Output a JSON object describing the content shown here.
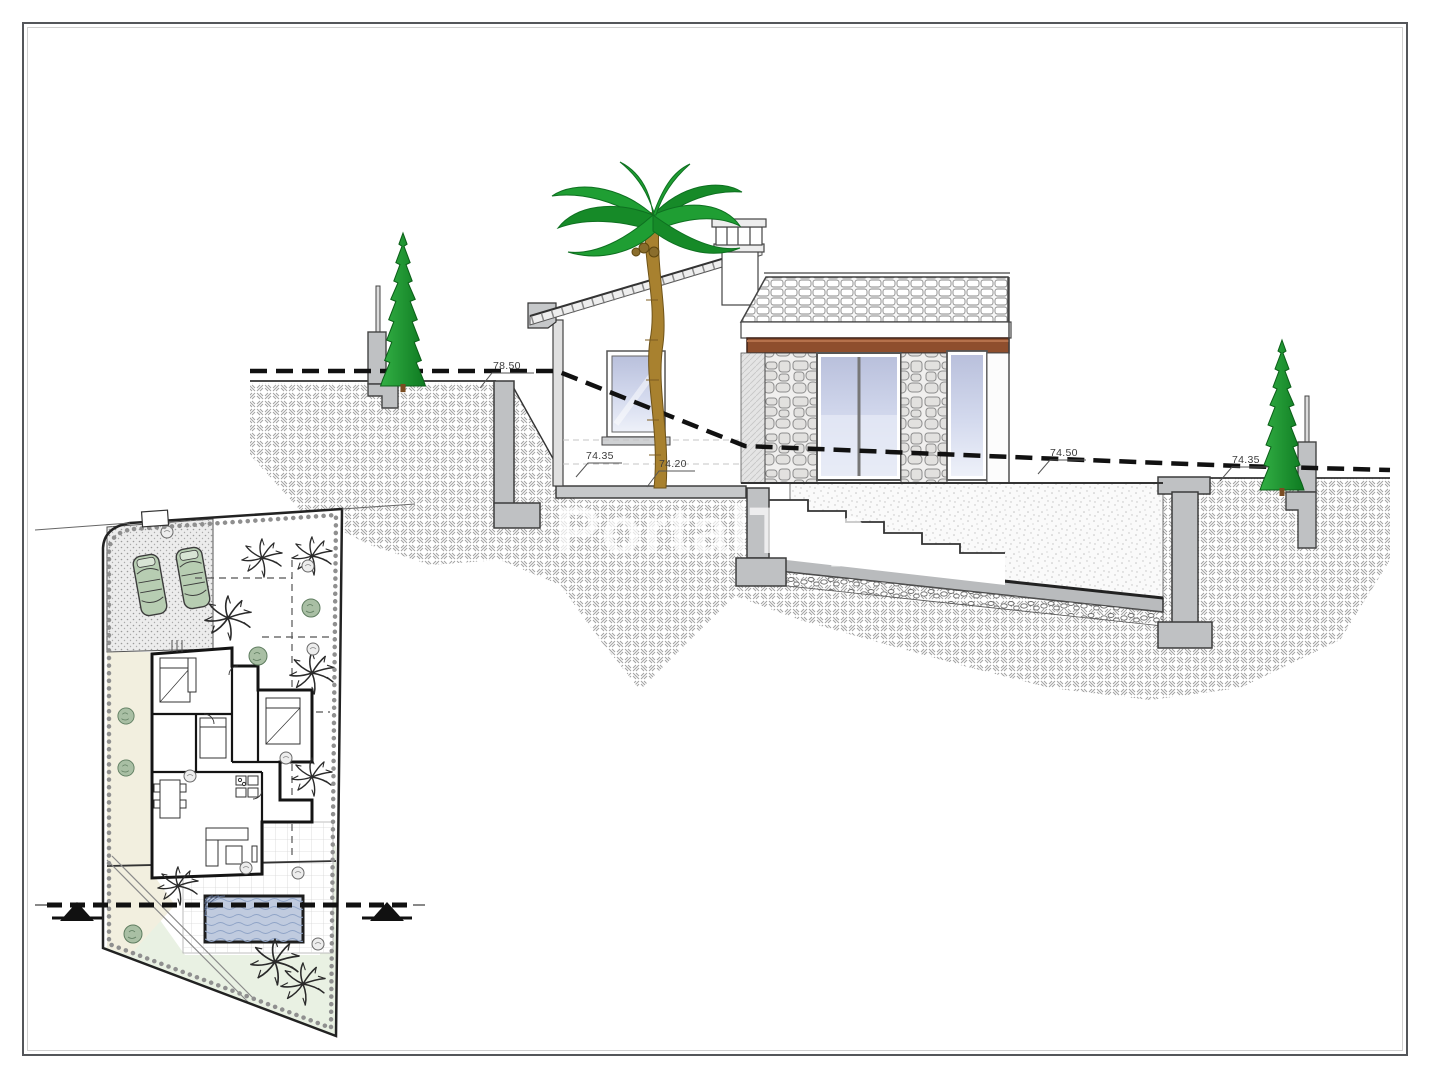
{
  "page": {
    "background": "#ffffff",
    "frame_color": "#54565a"
  },
  "watermark": {
    "text": "PortalTop",
    "color": "#ffffff"
  },
  "section_view": {
    "elevation_labels": [
      {
        "id": "left-plateau",
        "text": "78.50"
      },
      {
        "id": "floor-left",
        "text": "74.35"
      },
      {
        "id": "floor-terrace",
        "text": "74.20"
      },
      {
        "id": "mid-slope",
        "text": "74.50"
      },
      {
        "id": "right-ground",
        "text": "74.35"
      }
    ],
    "colors": {
      "terrain_hatch": "#a2a2a2",
      "concrete": "#bfc1c3",
      "beam_wood": "#8e4e2d",
      "glass": "#ccd3e9",
      "palm_green": "#1f9e33",
      "cypress_green": "#18912a"
    }
  },
  "site_plan": {
    "colors": {
      "car": "#b7cdb2",
      "pool_water": "#c0cbdf",
      "lawn": "#e9f1e3",
      "path_band": "#f2efdf"
    },
    "icons": [
      "palm-tree-icon",
      "cypress-tree-icon",
      "car-icon",
      "bush-icon",
      "pool-icon",
      "section-arrow-icon",
      "hedge-icon"
    ]
  }
}
